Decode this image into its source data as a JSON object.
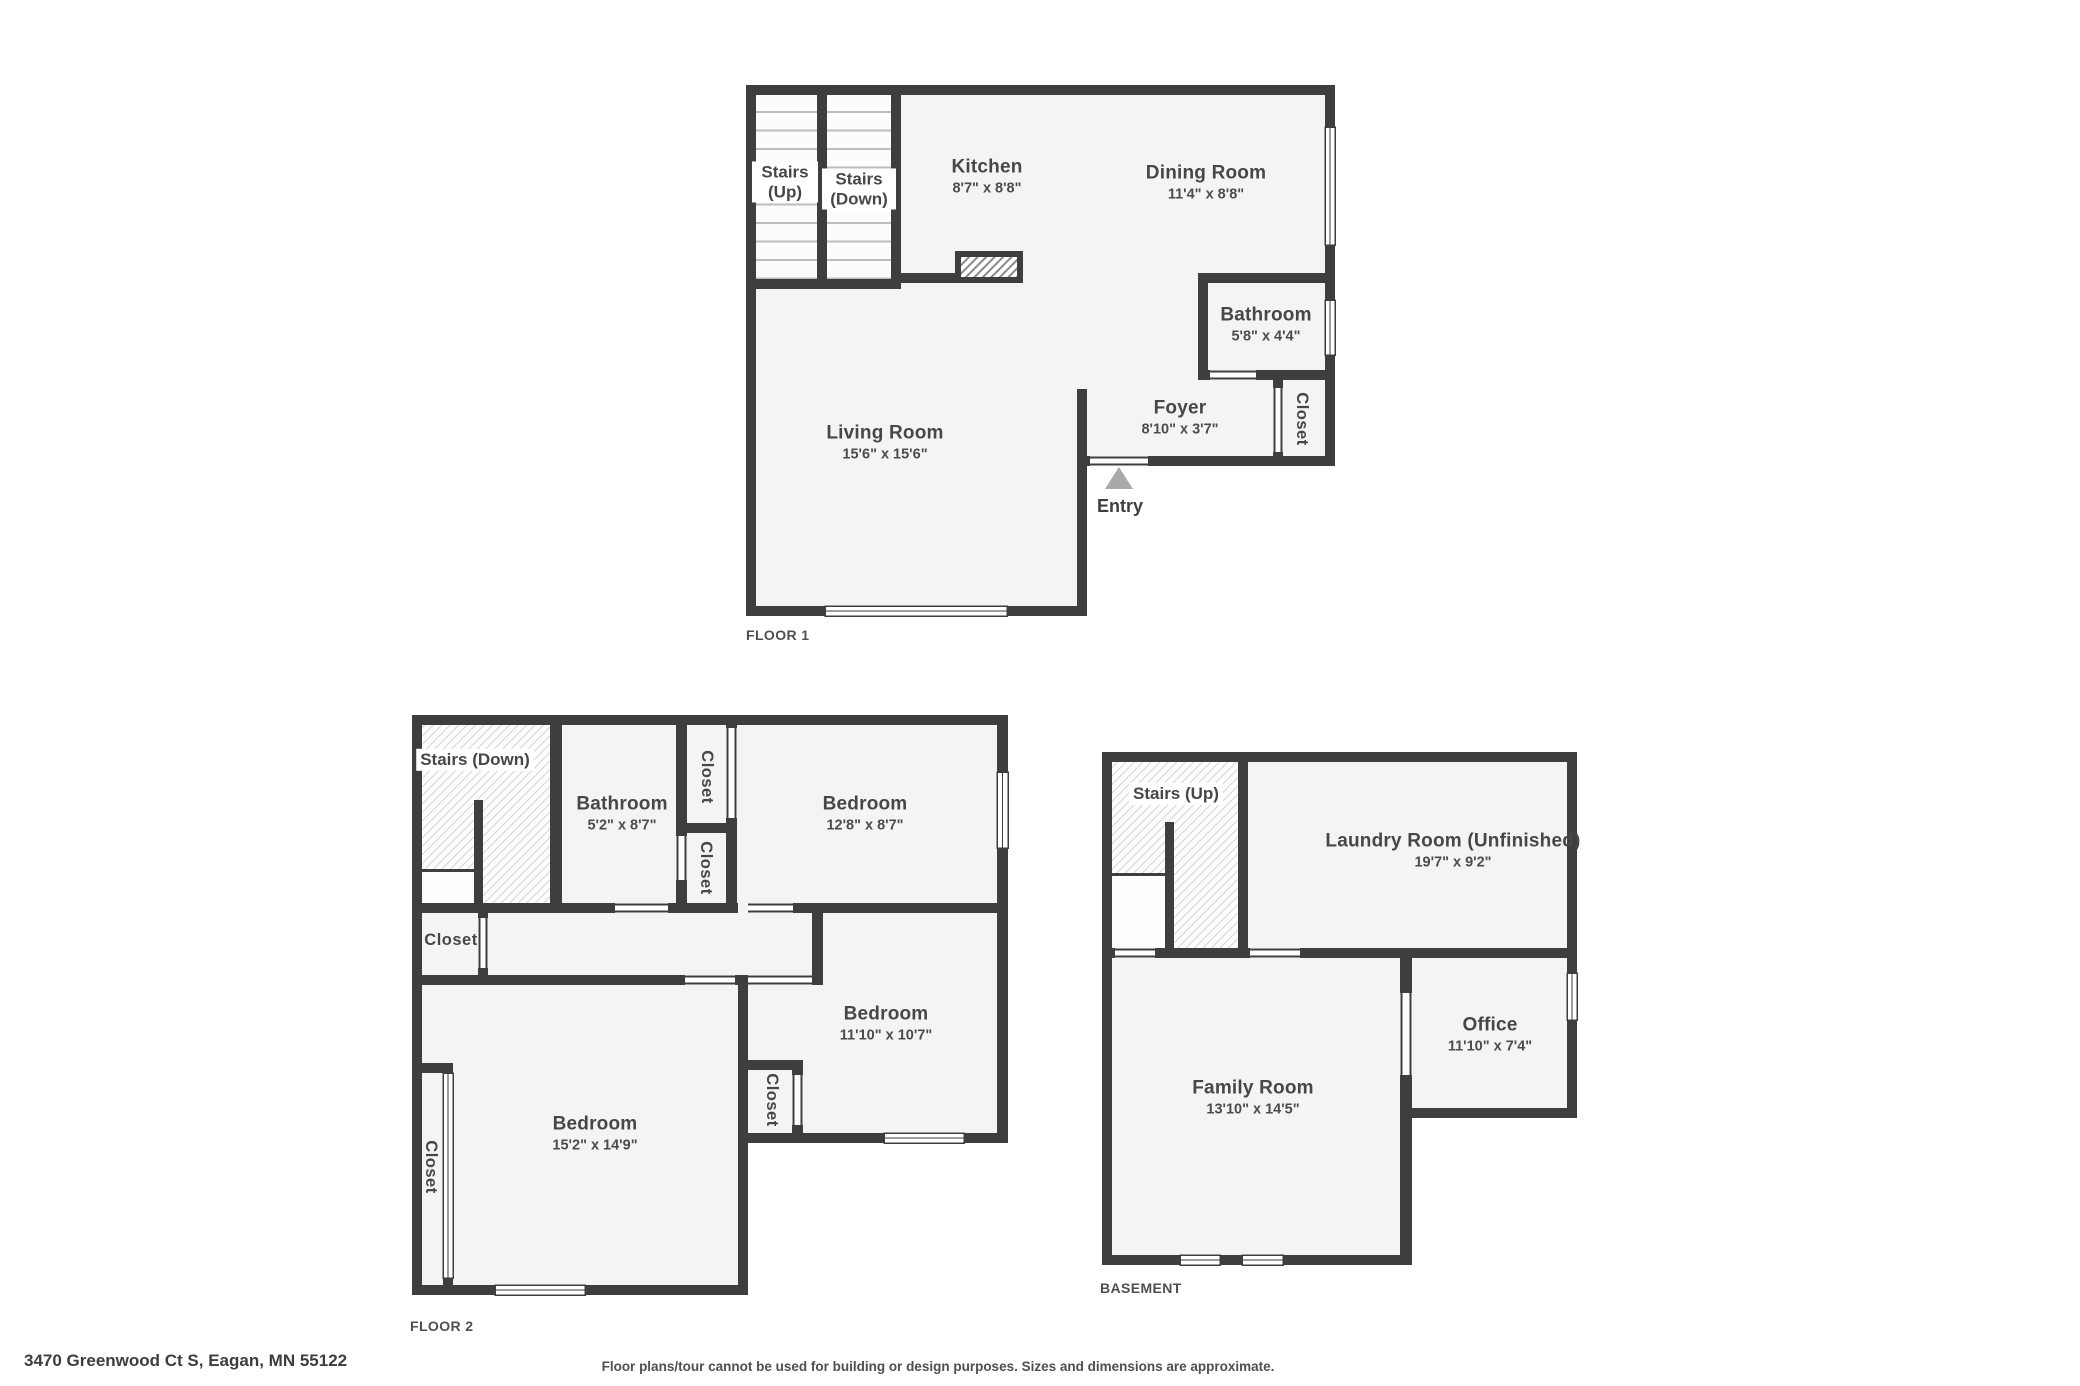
{
  "address": "3470 Greenwood Ct S, Eagan, MN 55122",
  "disclaimer": "Floor plans/tour cannot be used for building or design purposes. Sizes and dimensions are approximate.",
  "colors": {
    "wall": "#3e3e3e",
    "floor_fill": "#f4f4f4",
    "hatch_line": "#d4d4d4",
    "counter_hatch_line": "#8a8a8a",
    "stair_tread": "#bdbdbd",
    "entry_arrow": "#a9a9a9",
    "text": "#474747",
    "background": "#ffffff"
  },
  "floor1": {
    "title": "FLOOR 1",
    "stairs_up": "Stairs (Up)",
    "stairs_down": "Stairs (Down)",
    "closet": "Closet",
    "entry": "Entry",
    "rooms": {
      "kitchen": {
        "name": "Kitchen",
        "dims": "8'7\" x 8'8\""
      },
      "dining_room": {
        "name": "Dining Room",
        "dims": "11'4\" x 8'8\""
      },
      "bathroom": {
        "name": "Bathroom",
        "dims": "5'8\" x 4'4\""
      },
      "living_room": {
        "name": "Living Room",
        "dims": "15'6\" x 15'6\""
      },
      "foyer": {
        "name": "Foyer",
        "dims": "8'10\" x 3'7\""
      }
    }
  },
  "floor2": {
    "title": "FLOOR 2",
    "stairs_down": "Stairs (Down)",
    "closet": "Closet",
    "rooms": {
      "bathroom": {
        "name": "Bathroom",
        "dims": "5'2\" x 8'7\""
      },
      "bedroom_1": {
        "name": "Bedroom",
        "dims": "12'8\" x 8'7\""
      },
      "bedroom_2": {
        "name": "Bedroom",
        "dims": "11'10\" x 10'7\""
      },
      "bedroom_3": {
        "name": "Bedroom",
        "dims": "15'2\" x 14'9\""
      }
    }
  },
  "basement": {
    "title": "BASEMENT",
    "stairs_up": "Stairs (Up)",
    "rooms": {
      "laundry_room": {
        "name": "Laundry Room (Unfinished)",
        "dims": "19'7\" x 9'2\""
      },
      "family_room": {
        "name": "Family Room",
        "dims": "13'10\" x 14'5\""
      },
      "office": {
        "name": "Office",
        "dims": "11'10\" x 7'4\""
      }
    }
  }
}
